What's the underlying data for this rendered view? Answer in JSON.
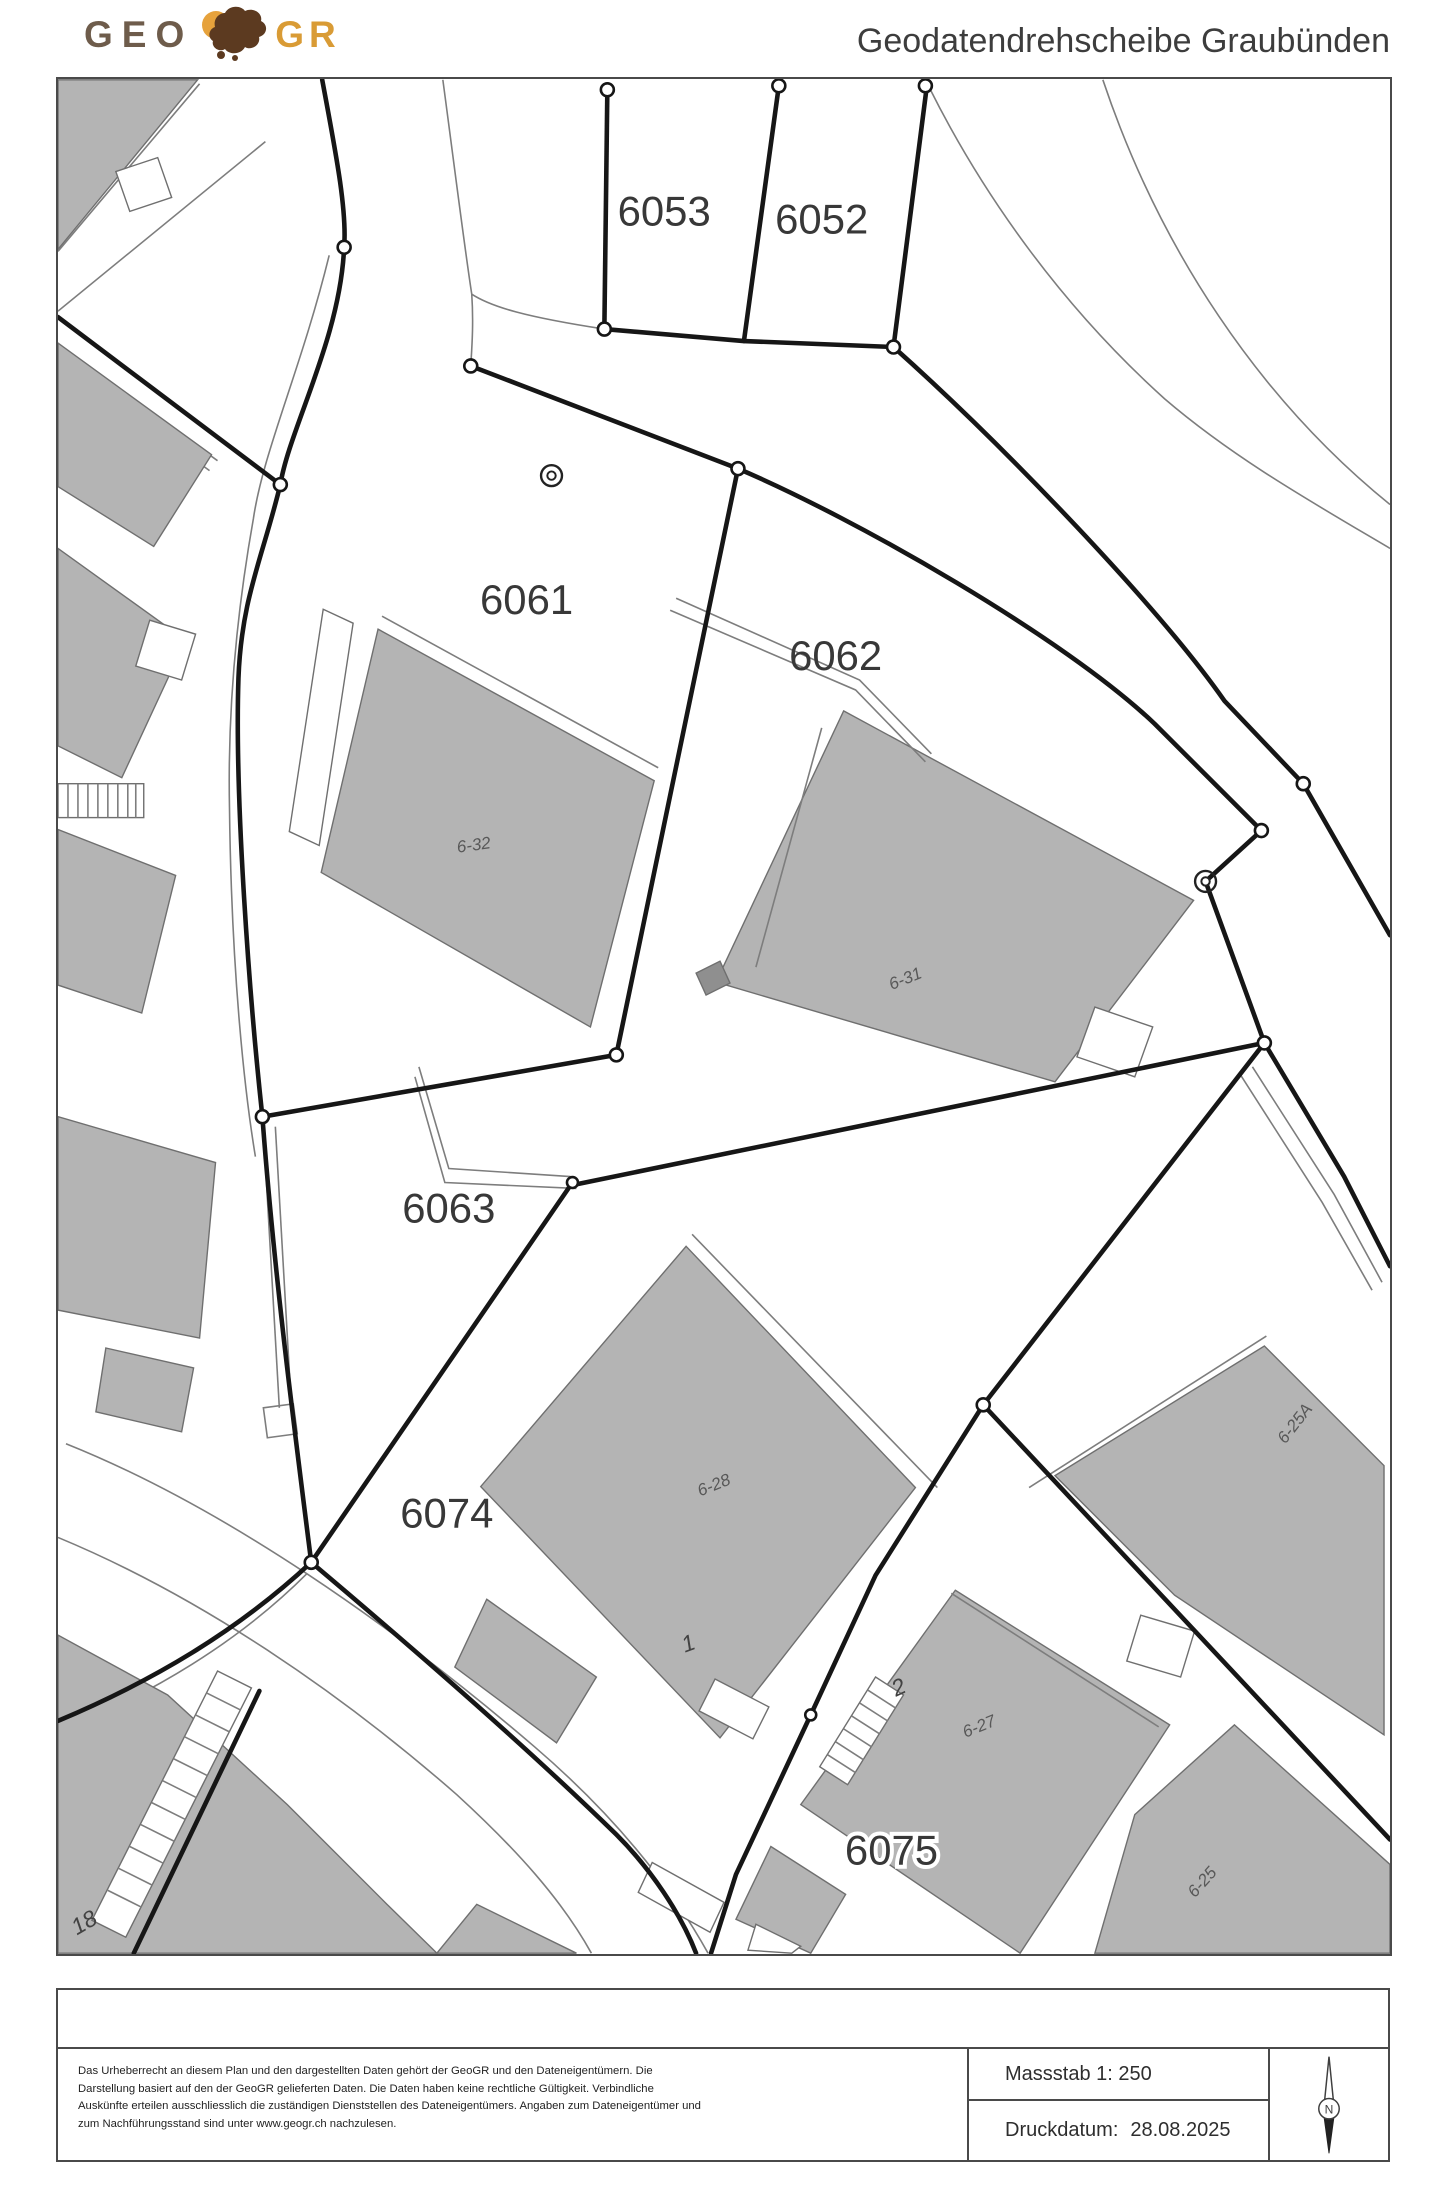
{
  "header": {
    "title": "Geodatendrehscheibe Graubünden",
    "logo": {
      "geo": "GEO",
      "gr": "GR"
    }
  },
  "map": {
    "parcel_labels": [
      {
        "id": "6053"
      },
      {
        "id": "6052"
      },
      {
        "id": "6061"
      },
      {
        "id": "6062"
      },
      {
        "id": "6063"
      },
      {
        "id": "6074"
      },
      {
        "id": "6075"
      }
    ],
    "building_labels": [
      {
        "id": "6-32"
      },
      {
        "id": "6-31"
      },
      {
        "id": "6-28"
      },
      {
        "id": "6-25A"
      },
      {
        "id": "6-27"
      },
      {
        "id": "6-25"
      }
    ],
    "house_numbers": [
      {
        "id": "1"
      },
      {
        "id": "2"
      },
      {
        "id": "18"
      }
    ]
  },
  "footer": {
    "disclaimer_lines": [
      "Das Urheberrecht an diesem Plan und den dargestellten Daten gehört der GeoGR und den Dateneigentümern. Die",
      "Darstellung basiert auf den der GeoGR gelieferten Daten. Die Daten haben keine rechtliche Gültigkeit. Verbindliche",
      "Auskünfte erteilen ausschliesslich die zuständigen Dienststellen des Dateneigentümers. Angaben zum Dateneigentümer und",
      "zum Nachführungsstand sind unter www.geogr.ch nachzulesen."
    ],
    "scale_text": "Massstab 1: 250",
    "date_label": "Druckdatum:",
    "date_value": "28.08.2025",
    "north_letter": "N"
  },
  "colors": {
    "building_fill": "#b4b4b4",
    "building_stroke": "#6f6f6f",
    "boundary_line": "#161616",
    "road_line": "#7d7d7d",
    "logo_geo": "#6e5c4b",
    "logo_gr": "#d99b35",
    "logo_blob": "#5c3a20",
    "logo_circle": "#e6a23c"
  }
}
